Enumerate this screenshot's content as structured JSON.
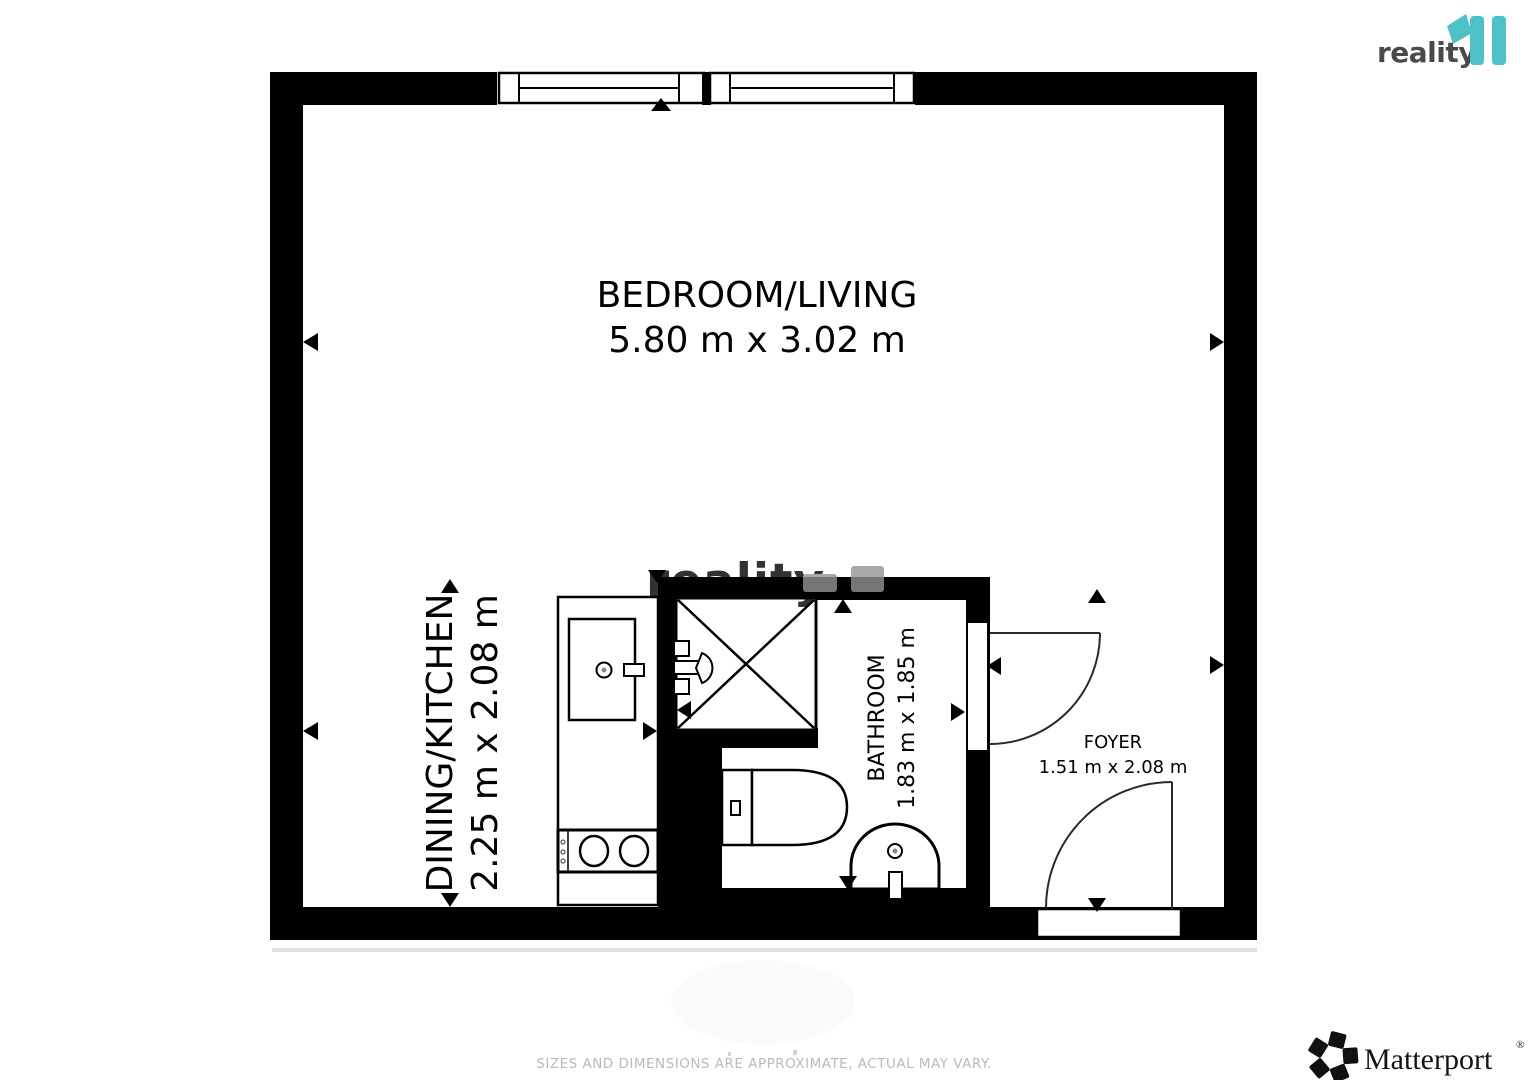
{
  "branding": {
    "reality_text": "reality",
    "reality_accent_color": "#4ec1c8",
    "matterport_text": "Matterport",
    "registered_mark": "®"
  },
  "floorplan": {
    "watermark_text": "reality",
    "wall_color": "#000000",
    "rooms": [
      {
        "name": "BEDROOM/LIVING",
        "dimensions": "5.80 m x 3.02 m"
      },
      {
        "name": "DINING/KITCHEN",
        "dimensions": "2.25 m x 2.08 m"
      },
      {
        "name": "BATHROOM",
        "dimensions": "1.83 m x 1.85 m"
      },
      {
        "name": "FOYER",
        "dimensions": "1.51 m x 2.08 m"
      }
    ]
  },
  "footer": {
    "disclaimer": "SIZES AND DIMENSIONS ARE APPROXIMATE, ACTUAL MAY VARY."
  }
}
